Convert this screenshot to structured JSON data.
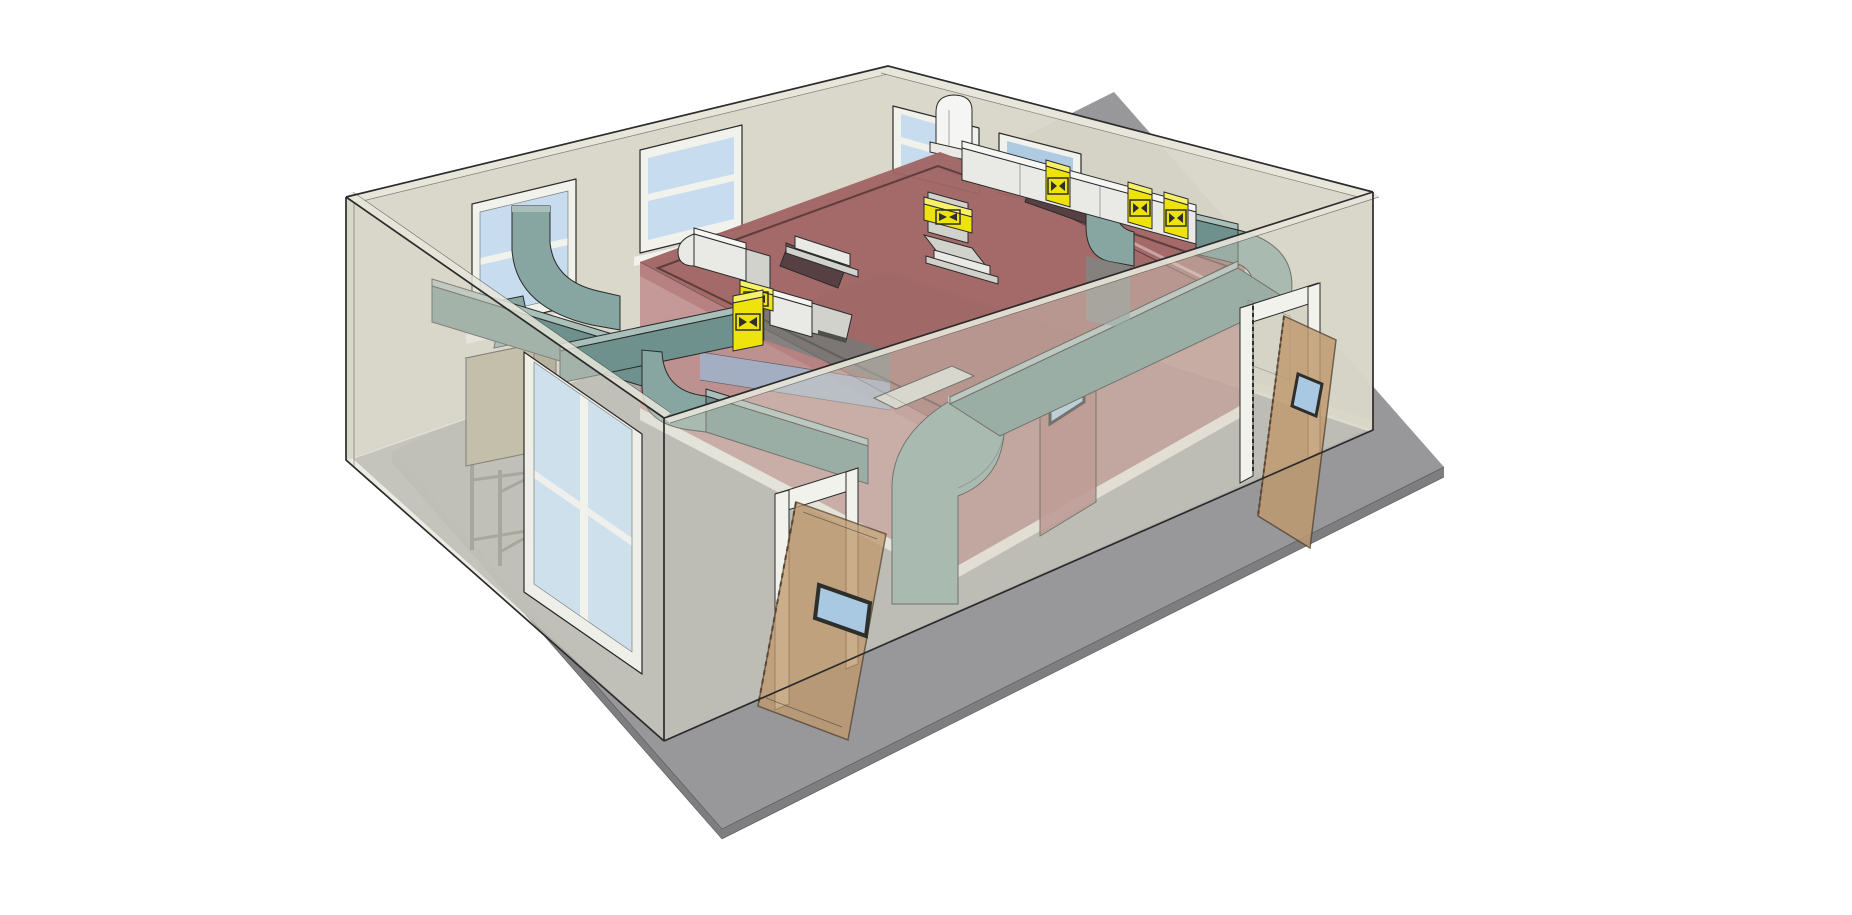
{
  "meta": {
    "description": "Isometric cutaway 3D model of a mechanical room: translucent exterior walls, two red-roofed inner rooms, teal and white HVAC ductwork with yellow fire dampers, an AHU on a stand, wooden doors and windows",
    "background": "#ffffff"
  },
  "palette": {
    "ground": "#98989A",
    "slab_edge": "#7E7E80",
    "floor": "#ABABA9",
    "trim": "#EDEDE7",
    "wall": "#D8D6C8",
    "wall_top": "#E8E6DA",
    "frame": "#F2F2EC",
    "glass": "#C7DCEE",
    "glass_mid": "#AFCBE2",
    "glass_dark": "#9BB8D4",
    "roof": "#A06565",
    "roof_edge": "#8F5757",
    "roof_line": "#5E3D3D",
    "roof_seam": "#C9A4A4",
    "room_wall": "#C08B8B",
    "room_wall_dark": "#B37E7E",
    "room_door": "#AD7575",
    "teal_top": "#A9BFBA",
    "teal_side": "#6F918D",
    "teal_front": "#87A6A1",
    "teal_dark": "#5F817D",
    "white_top": "#F5F5F3",
    "white_front": "#E9E9E6",
    "white_side": "#D2D2CD",
    "damper_yellow": "#EFE30E",
    "damper_yellow_top": "#F7F06A",
    "damper_yellow_side": "#C9BC00",
    "wood": "#C09A6F",
    "vision_glass": "#A9C8E2",
    "ahu": "#AFA88D",
    "ahu_top": "#C6BFA6",
    "ahu_side": "#968F74",
    "stand": "#6E6E68",
    "diffuser": "#564044",
    "diffuser_top": "#6E5257",
    "pad": "#D8D8D1",
    "symbol_dark": "#2E2E2A",
    "outline": "#2B2B2B",
    "slot_dark": "#4E4E4A"
  },
  "scene": {
    "ground": {
      "label": "concrete slab apron"
    },
    "shell": {
      "label": "translucent exterior walls",
      "windows_back_left_wall": 2,
      "windows_back_right_wall": 2,
      "glazed_window_front_wall": 1
    },
    "inner_rooms": {
      "label": "red-roofed inner rooms",
      "count": 2,
      "slot_diffusers": 2,
      "interior_door_vision_window": true,
      "window_band": true
    },
    "doors": {
      "front_door": {
        "state": "open",
        "material": "wood",
        "vision_panel": true
      },
      "side_door": {
        "state": "open",
        "material": "wood",
        "vision_panel": true
      }
    },
    "hvac": {
      "ahu": {
        "label": "air handling unit on steel stand"
      },
      "window_intake_elbows": 2,
      "drop_elbows": 3,
      "roof_pedestals": 2,
      "fire_dampers": {
        "count": 6,
        "symbol": "bowtie-in-box"
      }
    }
  }
}
